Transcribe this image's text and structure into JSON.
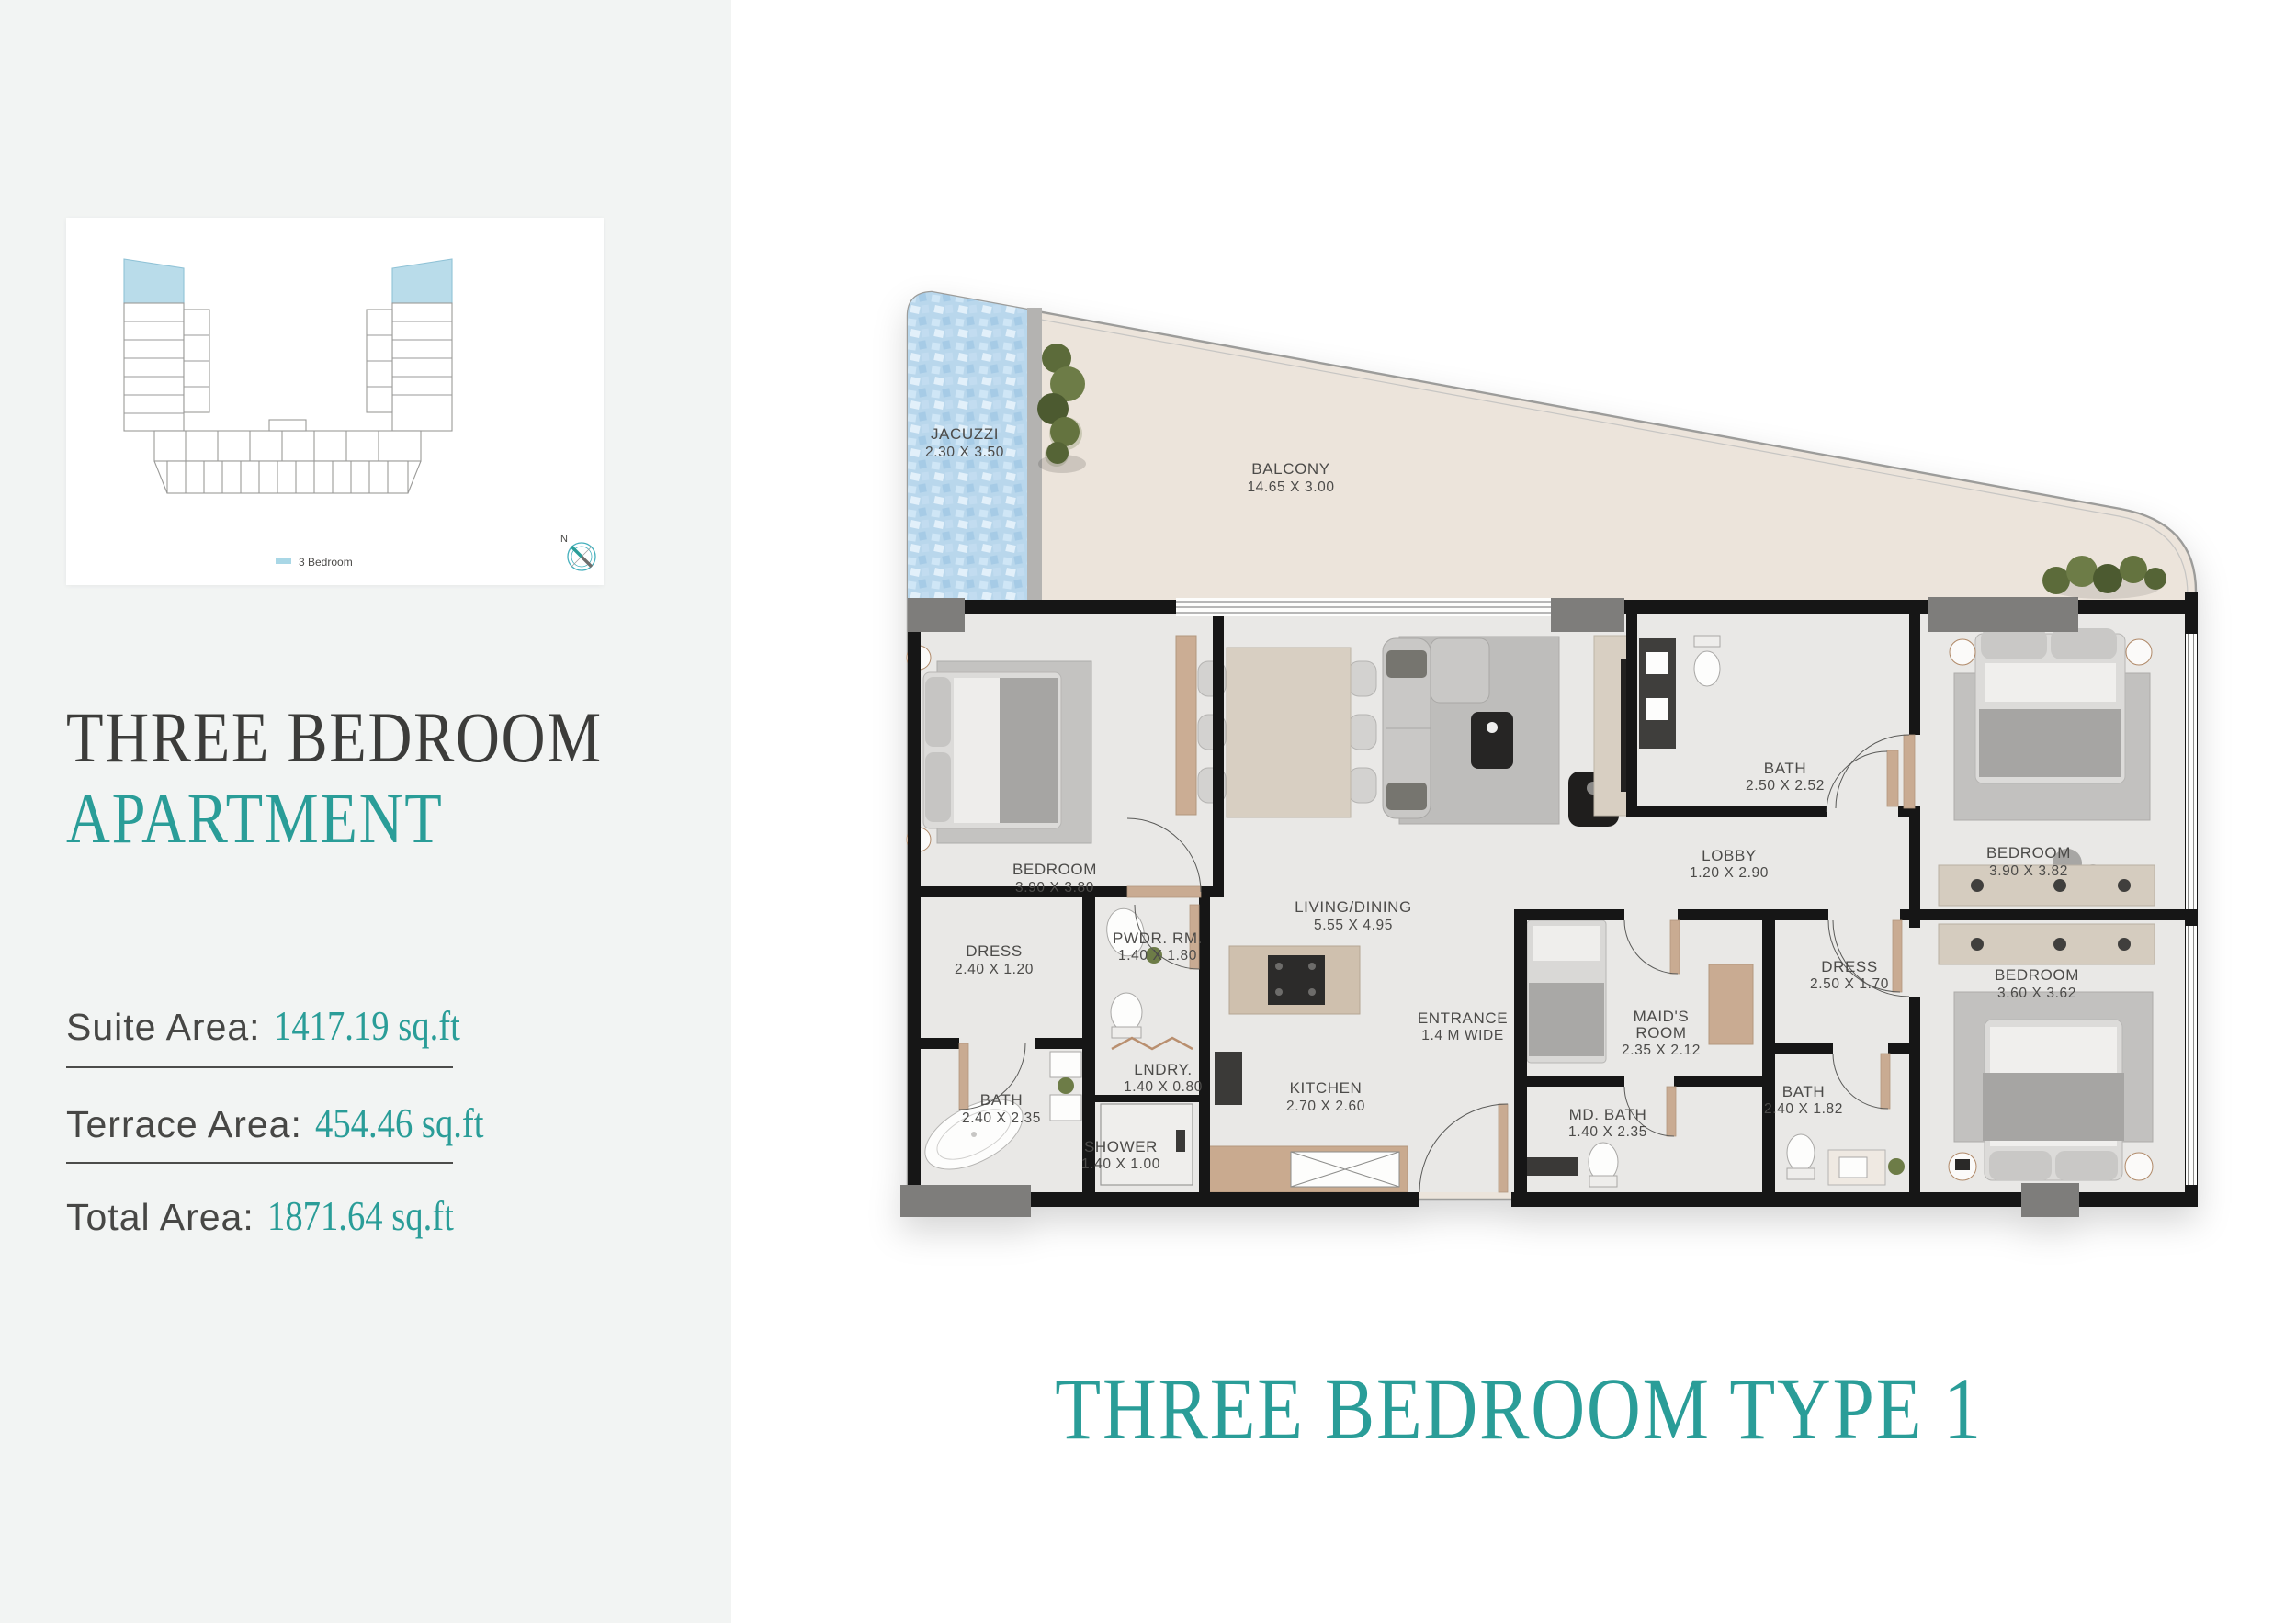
{
  "sidebar": {
    "overview_card": {
      "legend": {
        "label": "3 Bedroom",
        "swatch_color": "#a9d7e6"
      },
      "compass": {
        "label": "N"
      }
    },
    "title": {
      "line1": "THREE BEDROOM",
      "line2": "APARTMENT"
    },
    "areas": [
      {
        "label": "Suite Area:",
        "value": "1417.19 sq.ft"
      },
      {
        "label": "Terrace Area:",
        "value": "454.46 sq.ft"
      },
      {
        "label": "Total Area:",
        "value": "1871.64 sq.ft"
      }
    ]
  },
  "plan": {
    "footer_title": "THREE BEDROOM TYPE 1",
    "rooms": {
      "jacuzzi": {
        "name": "JACUZZI",
        "dims": "2.30 X 3.50"
      },
      "balcony": {
        "name": "BALCONY",
        "dims": "14.65 X 3.00"
      },
      "bedroom1": {
        "name": "BEDROOM",
        "dims": "3.90 X 3.80"
      },
      "dress1": {
        "name": "DRESS",
        "dims": "2.40 X 1.20"
      },
      "bath1": {
        "name": "BATH",
        "dims": "2.40 X 2.35"
      },
      "shower": {
        "name": "SHOWER",
        "dims": "1.40 X 1.00"
      },
      "pwdr": {
        "name": "PWDR. RM.",
        "dims": "1.40 X 1.80"
      },
      "lndry": {
        "name": "LNDRY.",
        "dims": "1.40 X 0.80"
      },
      "living": {
        "name": "LIVING/DINING",
        "dims": "5.55 X 4.95"
      },
      "kitchen": {
        "name": "KITCHEN",
        "dims": "2.70 X 2.60"
      },
      "entrance": {
        "name": "ENTRANCE",
        "dims": "1.4 M WIDE"
      },
      "bath2": {
        "name": "BATH",
        "dims": "2.50 X 2.52"
      },
      "lobby": {
        "name": "LOBBY",
        "dims": "1.20 X 2.90"
      },
      "maids": {
        "name1": "MAID'S",
        "name2": "ROOM",
        "dims": "2.35 X 2.12"
      },
      "mdbath": {
        "name": "MD. BATH",
        "dims": "1.40 X 2.35"
      },
      "dress2": {
        "name": "DRESS",
        "dims": "2.50 X 1.70"
      },
      "bath3": {
        "name": "BATH",
        "dims": "2.40 X 1.82"
      },
      "bedroom2": {
        "name": "BEDROOM",
        "dims": "3.90 X 3.82"
      },
      "bedroom3": {
        "name": "BEDROOM",
        "dims": "3.60 X 3.62"
      }
    }
  },
  "colors": {
    "accent_teal": "#2a9d98",
    "legend_blue": "#a9d7e6",
    "jacuzzi_blue": "#b9d7ec",
    "balcony_beige": "#ece4db",
    "wall_black": "#161616",
    "door_tan": "#c9ab92",
    "title_dark": "#3c3c3a"
  }
}
